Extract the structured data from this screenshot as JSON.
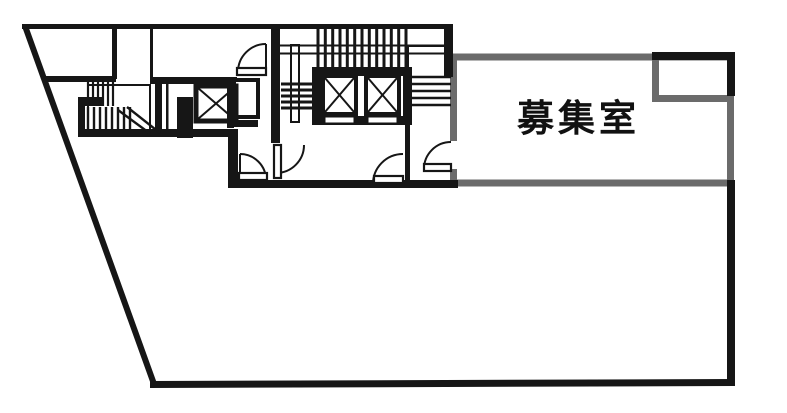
{
  "plan": {
    "type": "floor-plan",
    "room": {
      "label": "募集室"
    },
    "colors": {
      "exterior_and_core_walls": "#161616",
      "leased_room_walls": "#6b6b6b",
      "background": "#ffffff"
    },
    "features": [
      "building-outline",
      "left-stairwell",
      "top-staircase",
      "single-elevator",
      "double-elevator-core",
      "swing-doors",
      "leased-room",
      "top-right-notch"
    ]
  }
}
